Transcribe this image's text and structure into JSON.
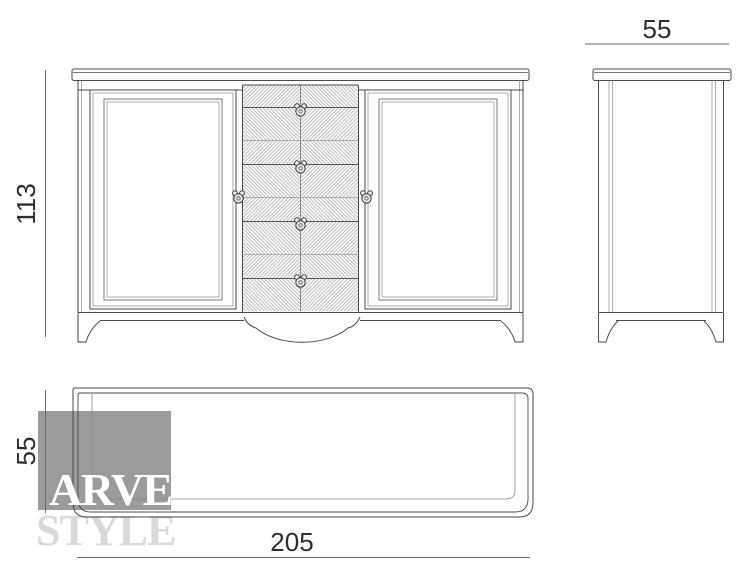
{
  "watermark": {
    "line1": "ARVE",
    "line2": "STYLE"
  },
  "dimensions": {
    "height": "113",
    "side_depth": "55",
    "plan_depth": "55",
    "width": "205"
  },
  "colors": {
    "outline": "#4a4a4a",
    "secondary_line": "#9a9a9a",
    "dimension_text": "#2e2e2e",
    "watermark_box": "#9b9b9e",
    "watermark_primary": "#ffffff",
    "watermark_secondary": "#d9d9d9",
    "background": "#ffffff"
  }
}
